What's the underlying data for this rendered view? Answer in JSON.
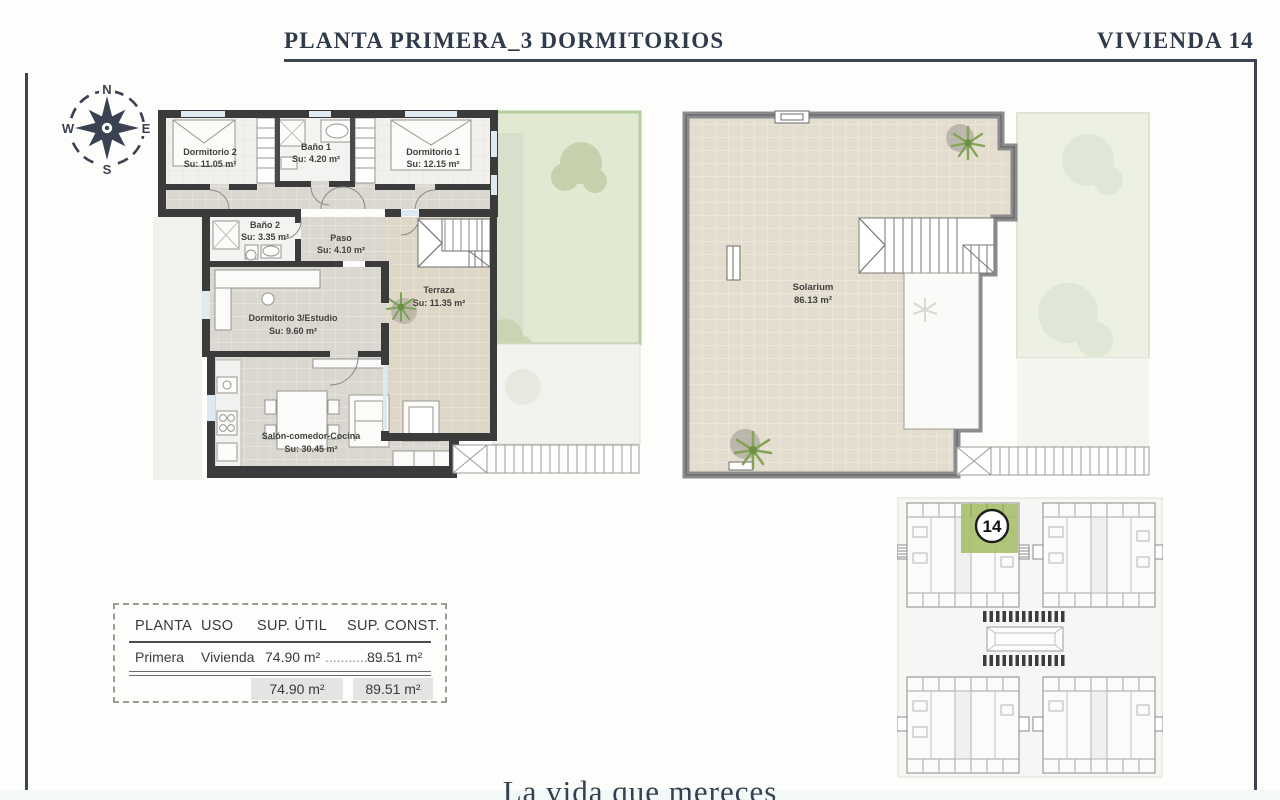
{
  "header": {
    "title": "PLANTA PRIMERA_3 DORMITORIOS",
    "unit_label": "VIVIENDA 14"
  },
  "compass": {
    "north": "N",
    "east": "E",
    "south": "S",
    "west": "W"
  },
  "floor_plan": {
    "rooms": [
      {
        "name": "Dormitorio 2",
        "area": "Su: 11.05 m²"
      },
      {
        "name": "Baño 1",
        "area": "Su: 4.20 m²"
      },
      {
        "name": "Dormitorio 1",
        "area": "Su: 12.15 m²"
      },
      {
        "name": "Baño 2",
        "area": "Su: 3.35 m²"
      },
      {
        "name": "Paso",
        "area": "Su: 4.10 m²"
      },
      {
        "name": "Dormitorio 3/Estudio",
        "area": "Su: 9.60 m²"
      },
      {
        "name": "Terraza",
        "area": "Su: 11.35 m²"
      },
      {
        "name": "Salón-comedor-Cocina",
        "area": "Su: 30.45 m²"
      }
    ]
  },
  "solarium_plan": {
    "room": {
      "name": "Solarium",
      "area": "86.13 m²"
    }
  },
  "site_plan": {
    "highlighted_unit": "14"
  },
  "spec_table": {
    "headers": [
      "PLANTA",
      "USO",
      "SUP. ÚTIL",
      "SUP. CONST."
    ],
    "row": {
      "planta": "Primera",
      "uso": "Vivienda",
      "sup_util": "74.90 m²",
      "leader": "...............",
      "sup_const": "89.51 m²"
    },
    "totals": {
      "sup_util": "74.90 m²",
      "sup_const": "89.51 m²"
    }
  },
  "footer": {
    "tagline": "La vida que mereces"
  },
  "colors": {
    "accent_navy": "#32404f",
    "garden_green": "#dfe8d0",
    "highlight_green": "#a9bf6b",
    "wall_dark": "#3b3b3b",
    "tile_gray": "#d9d7d0",
    "tile_beige": "#ded6c6",
    "total_cell_gray": "#e4e4e2"
  }
}
